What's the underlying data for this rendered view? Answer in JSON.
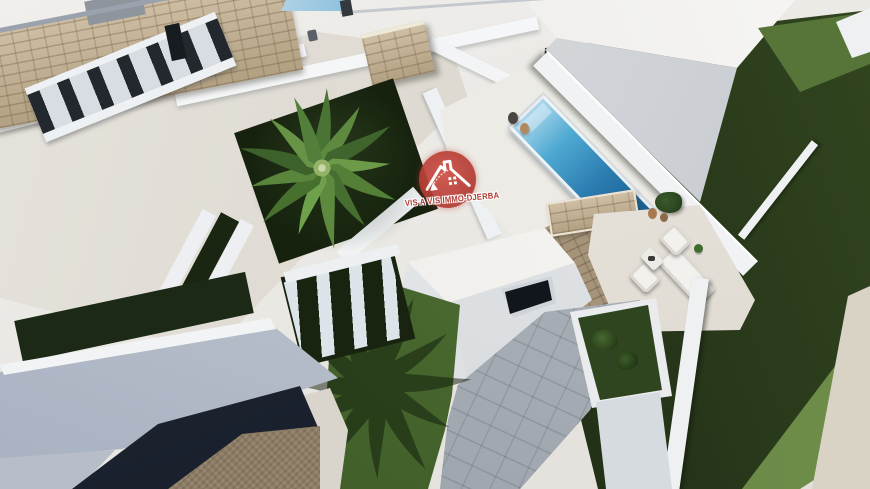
{
  "meta": {
    "scene": "aerial-3d-architectural-render",
    "description": "Top-down 3D visualisation of modern white villas with courtyard palm, lap pool, lounge terrace and gardens"
  },
  "watermark": {
    "caption": "VIS A VIS IMMO-DJERBA",
    "logo": "house-roof-icon",
    "color": "#b23a31"
  },
  "palette": {
    "wall_white": "#f0f2f4",
    "roof_beige": "#dcd8d0",
    "stone_tan": "#bfae93",
    "stone_shadow": "#a6947a",
    "grass_dark": "#243218",
    "grass_deep": "#141f0c",
    "grass_medium": "#5f7d3c",
    "lawn_green": "#3f5c28",
    "pool_light": "#aed8ec",
    "pool_deep": "#175a8e",
    "navy": "#1c2330",
    "gravel": "#8d7c64",
    "slat_dark": "#23282e",
    "tile_gray": "#aab0b7",
    "path_beige": "#d9d5cc",
    "logo_red": "#b23a31",
    "window_dark": "#10161b"
  },
  "scene": {
    "elements": [
      "white-villa-rooftop-terrace",
      "stone-feature-wall",
      "timber-pergola",
      "palm-tree-courtyard",
      "lap-swimming-pool",
      "stone-clad-chimney",
      "outdoor-lounge-set",
      "artificial-lawn-garden",
      "neighbouring-villa-roof",
      "dark-paved-patio",
      "gravel-ground",
      "garden-boundary-walls",
      "watermark-logo"
    ]
  }
}
